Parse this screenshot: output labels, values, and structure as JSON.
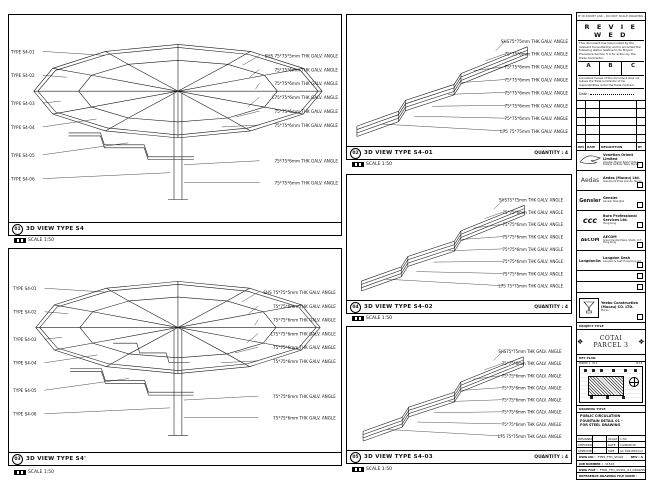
{
  "panels": {
    "p1": {
      "num": "01",
      "title": "3D VIEW TYPE S4",
      "scale": "SCALE 1:50",
      "left_labels": [
        "TYPE S4-01",
        "TYPE S4-02",
        "TYPE S4-03",
        "TYPE S4-04",
        "TYPE S4-05",
        "TYPE S4-06"
      ],
      "right_labels": [
        "SHS 75*75*5mm THK GALV. ANGLE",
        "75*75*6mm THK GALV. ANGLE",
        "75*75*6mm THK GALV. ANGLE",
        "L75*75*6mm THK GALV. ANGLE",
        "75*75*6mm THK GALV. ANGLE",
        "75*75*6mm THK GALV. ANGLE",
        "75*75*6mm THK GALV. ANGLE",
        "75*75*6mm THK GALV. ANGLE"
      ]
    },
    "p3": {
      "num": "03",
      "title": "3D VIEW TYPE S4'",
      "scale": "SCALE 1:50",
      "left_labels": [
        "TYPE S4-01",
        "TYPE S4-02",
        "TYPE S4-03",
        "TYPE S4-04",
        "TYPE S4-05",
        "TYPE S4-06"
      ],
      "right_labels": [
        "SHS 75*75*5mm THK GALV. ANGLE",
        "75*75*6mm THK GALV. ANGLE",
        "75*75*6mm THK GALV. ANGLE",
        "L75*75*6mm THK GALV. ANGLE",
        "75*75*6mm THK GALV. ANGLE",
        "75*75*6mm THK GALV. ANGLE",
        "75*75*6mm THK GALV. ANGLE",
        "75*75*6mm THK GALV. ANGLE"
      ]
    },
    "p2": {
      "num": "02",
      "title": "3D VIEW TYPE S4-01",
      "qty": "QUANTITY : 4",
      "scale": "SCALE 1:50",
      "ann": [
        "SHS75*75mm THK GALV. ANGLE",
        "75*75*6mm THK GALV. ANGLE",
        "75*75*6mm THK GALV. ANGLE",
        "75*75*6mm THK GALV. ANGLE",
        "75*75*6mm THK GALV. ANGLE",
        "75*75*6mm THK GALV. ANGLE",
        "75*75*6mm THK GALV. ANGLE",
        "L75 75*75mm THK GALV. ANGLE"
      ]
    },
    "p4": {
      "num": "04",
      "title": "3D VIEW TYPE S4-02",
      "qty": "QUANTITY : 4",
      "scale": "SCALE 1:50",
      "ann": [
        "SHS75*75mm THK GALV. ANGLE",
        "75*75*6mm THK GALV. ANGLE",
        "75*75*6mm THK GALV. ANGLE",
        "75*75*6mm THK GALV. ANGLE",
        "75*75*6mm THK GALV. ANGLE",
        "75*75*6mm THK GALV. ANGLE",
        "75*75*6mm THK GALV. ANGLE",
        "L75 75*75mm THK GALV. ANGLE"
      ]
    },
    "p5": {
      "num": "05",
      "title": "3D VIEW TYPE S4-03",
      "qty": "QUANTITY : 4",
      "scale": "SCALE 1:50",
      "ann": [
        "SHS75*75mm THK GALV. ANGLE",
        "75*75*6mm THK GALV. ANGLE",
        "75*75*6mm THK GALV. ANGLE",
        "75*75*6mm THK GALV. ANGLE",
        "75*75*6mm THK GALV. ANGLE",
        "75*75*6mm THK GALV. ANGLE",
        "75*75*6mm THK GALV. ANGLE",
        "L75 75*75mm THK GALV. ANGLE"
      ]
    }
  },
  "titleblock": {
    "strip": "IF IN DOUBT ASK - DO NOT SCALE DRAWING - ALL DIMENSIONS TO BE VERIFIED ON SITE",
    "stamp": {
      "title": "R E V I E W E D",
      "body": "This document has been noted by the relevant Consultant(s) and is accorded the following status relative to its Project Procedure Section 5.4 for action by the Trade Contractor.",
      "col_a": "A",
      "col_b": "B",
      "col_c": "C",
      "note": "Consultant review of this document does not relieve the Trade Contractor of his responsibilities under the Trade Contract.",
      "date_label": "Date :"
    },
    "revtable": {
      "h_rev": "REV",
      "h_date": "DATE",
      "h_desc": "DESCRIPTION",
      "h_by": "BY"
    },
    "logos": [
      {
        "logo_text": "",
        "name": "Venetian Orient Limited",
        "sub": "Venetian Macao Resort Hotel, Estrada da Baía, Taipa, Macau"
      },
      {
        "logo_text": "Aedas",
        "name": "Aedas (Macau) Ltd.",
        "sub": "Avenida da Praia Grande, Macau"
      },
      {
        "logo_text": "Gensler",
        "name": "Gensler",
        "sub": "Gensler Shanghai"
      },
      {
        "logo_text": "ccc",
        "name": "Buro Professional Services Ltd.",
        "sub": "Hong Kong"
      },
      {
        "logo_text": "AECOM",
        "name": "AECOM",
        "sub": "Grand Central Plaza, Shatin, N.T., Hong Kong"
      },
      {
        "logo_text": "LangdonSeah",
        "name": "Langdon Seah",
        "sub": "Langdon & Seah Hong Kong Ltd."
      }
    ],
    "contractor": {
      "name": "Yeebo Construction (Macau) CO. LTD.",
      "sub": "Macau"
    },
    "project": {
      "label": "PROJECT TITLE",
      "name": "COTAI PARCEL 3",
      "ornament": "❖"
    },
    "keyplan": {
      "label": "KEY PLAN",
      "tag1": "PARCEL 1",
      "tag2": "LP 2",
      "tag3": "N.T.S."
    },
    "drawing": {
      "label": "DRAWING TITLE",
      "line1": "PUBLIC CIRCULATION",
      "line2": "FOUNTAIN DETAIL 01 -",
      "line3": "FOR STEEL DRAWING"
    },
    "info": {
      "designed_label": "DESIGNED",
      "checked_label": "CHECKED",
      "approved_label": "APPROVED",
      "scale_label": "SCALE",
      "date_label": "DATE",
      "size_label": "SIZE",
      "designed": "",
      "checked": "-",
      "approved": "-",
      "scale": "1:50",
      "date": "14/MAR/16",
      "size": "A1 594x841mm"
    },
    "dwg": {
      "label": "DWG NO :",
      "value": "FTN5_FTD_S5401",
      "rev": "REV : A"
    },
    "job": {
      "label": "JOB NUMBER :",
      "value": "31526"
    },
    "file": {
      "label": "DWG FILE :",
      "value": "FTN5_FTD_S5401_03_DRAWING.dwg"
    },
    "ref": {
      "label": "REFERENCE DRAWING FILE NAME :"
    }
  }
}
